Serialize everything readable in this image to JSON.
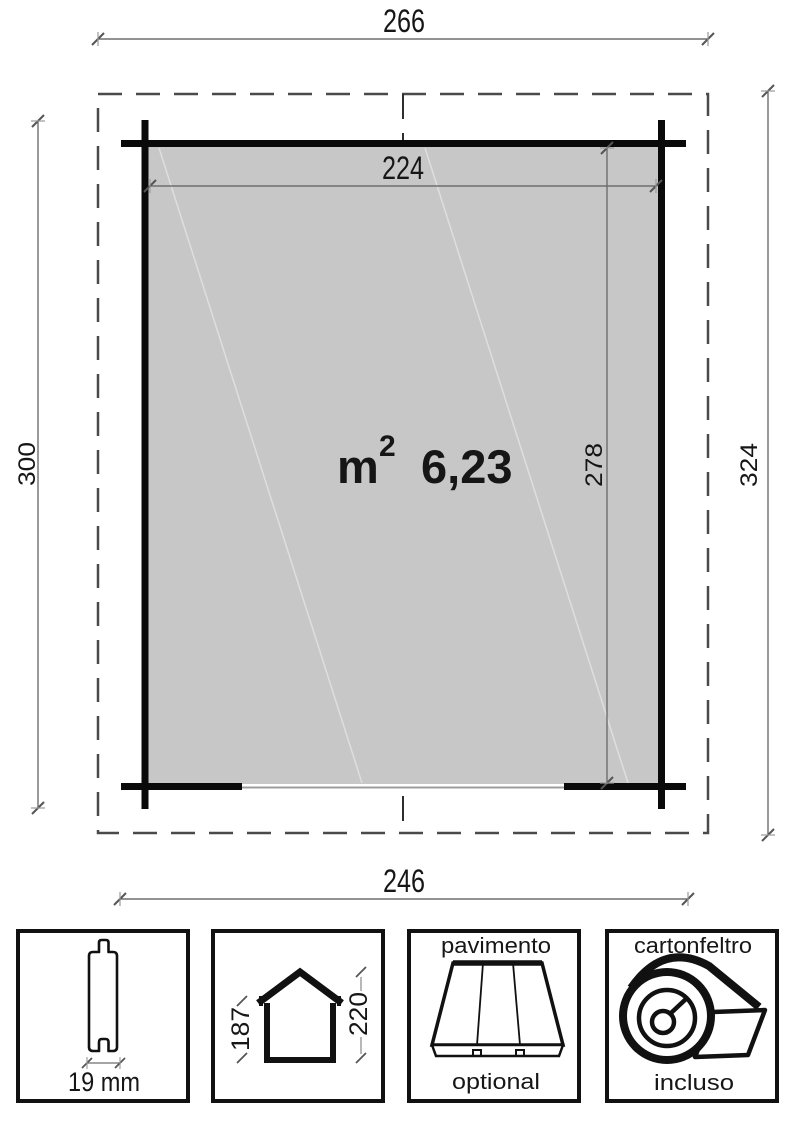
{
  "plan": {
    "roof_width": "266",
    "inner_width": "224",
    "base_width": "246",
    "side_left": "300",
    "side_right": "324",
    "inner_depth": "278",
    "area_unit": "m",
    "area_exponent": "2",
    "area_value": "6,23"
  },
  "legend": {
    "plank": {
      "thickness": "19 mm"
    },
    "elevation": {
      "eaves_height": "187",
      "ridge_height": "220"
    },
    "floor": {
      "title": "pavimento",
      "availability": "optional"
    },
    "roof_felt": {
      "title": "cartonfeltro",
      "availability": "incluso"
    }
  },
  "colors": {
    "floor_fill": "#c7c7c7",
    "wall": "#0a0a0a",
    "dashed_outline": "#4a4a4a",
    "dim_line": "#6e6e6e"
  }
}
